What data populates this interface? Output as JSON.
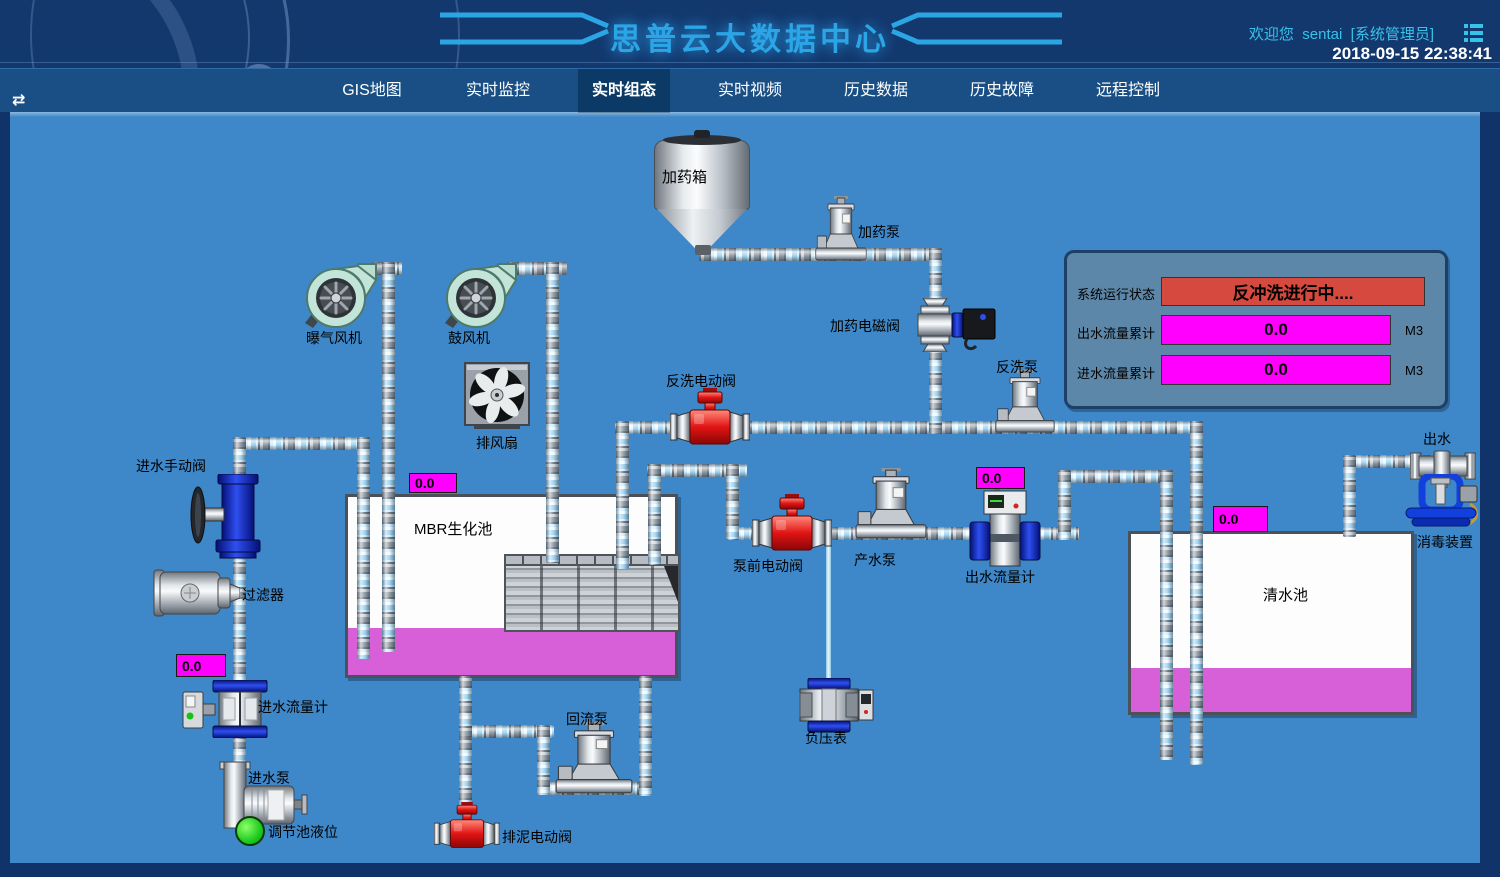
{
  "header": {
    "title": "思普云大数据中心",
    "welcome_prefix": "欢迎您",
    "username": "sentai",
    "role": "[系统管理员]",
    "datetime": "2018-09-15 22:38:41",
    "collapse_icon": "⇄"
  },
  "nav": {
    "tabs": [
      {
        "label": "GIS地图",
        "active": false
      },
      {
        "label": "实时监控",
        "active": false
      },
      {
        "label": "实时组态",
        "active": true
      },
      {
        "label": "实时视频",
        "active": false
      },
      {
        "label": "历史数据",
        "active": false
      },
      {
        "label": "历史故障",
        "active": false
      },
      {
        "label": "远程控制",
        "active": false
      }
    ]
  },
  "status_panel": {
    "rows": [
      {
        "label": "系统运行状态",
        "value": "反冲洗进行中....",
        "unit": ""
      },
      {
        "label": "出水流量累计",
        "value": "0.0",
        "unit": "M3"
      },
      {
        "label": "进水流量累计",
        "value": "0.0",
        "unit": "M3"
      }
    ]
  },
  "values": {
    "mbr_level": "0.0",
    "inlet_flow": "0.0",
    "outlet_flow": "0.0",
    "clean_level": "0.0"
  },
  "labels": {
    "dosing_tank": "加药箱",
    "dosing_pump": "加药泵",
    "dosing_solenoid_valve": "加药电磁阀",
    "aeration_blower": "曝气风机",
    "blower": "鼓风机",
    "exhaust_fan": "排风扇",
    "backwash_valve": "反洗电动阀",
    "backwash_pump": "反洗泵",
    "inlet_manual_valve": "进水手动阀",
    "filter": "过滤器",
    "mbr_tank": "MBR生化池",
    "prepump_valve": "泵前电动阀",
    "product_pump": "产水泵",
    "outlet_flowmeter": "出水流量计",
    "clean_tank": "清水池",
    "outlet": "出水",
    "disinfection": "消毒装置",
    "inlet_flowmeter": "进水流量计",
    "inlet_pump": "进水泵",
    "regulating_level": "调节池液位",
    "reflux_pump": "回流泵",
    "sludge_valve": "排泥电动阀",
    "vacuum_gauge": "负压表"
  },
  "colors": {
    "accent_cyan": "#2ca5e6",
    "alarm_red": "#d6493f",
    "value_magenta": "#ff00ff",
    "diagram_blue": "#3e87c8",
    "liquid_magenta": "#d75fd7",
    "indicator_green": "#1ecb1e"
  }
}
